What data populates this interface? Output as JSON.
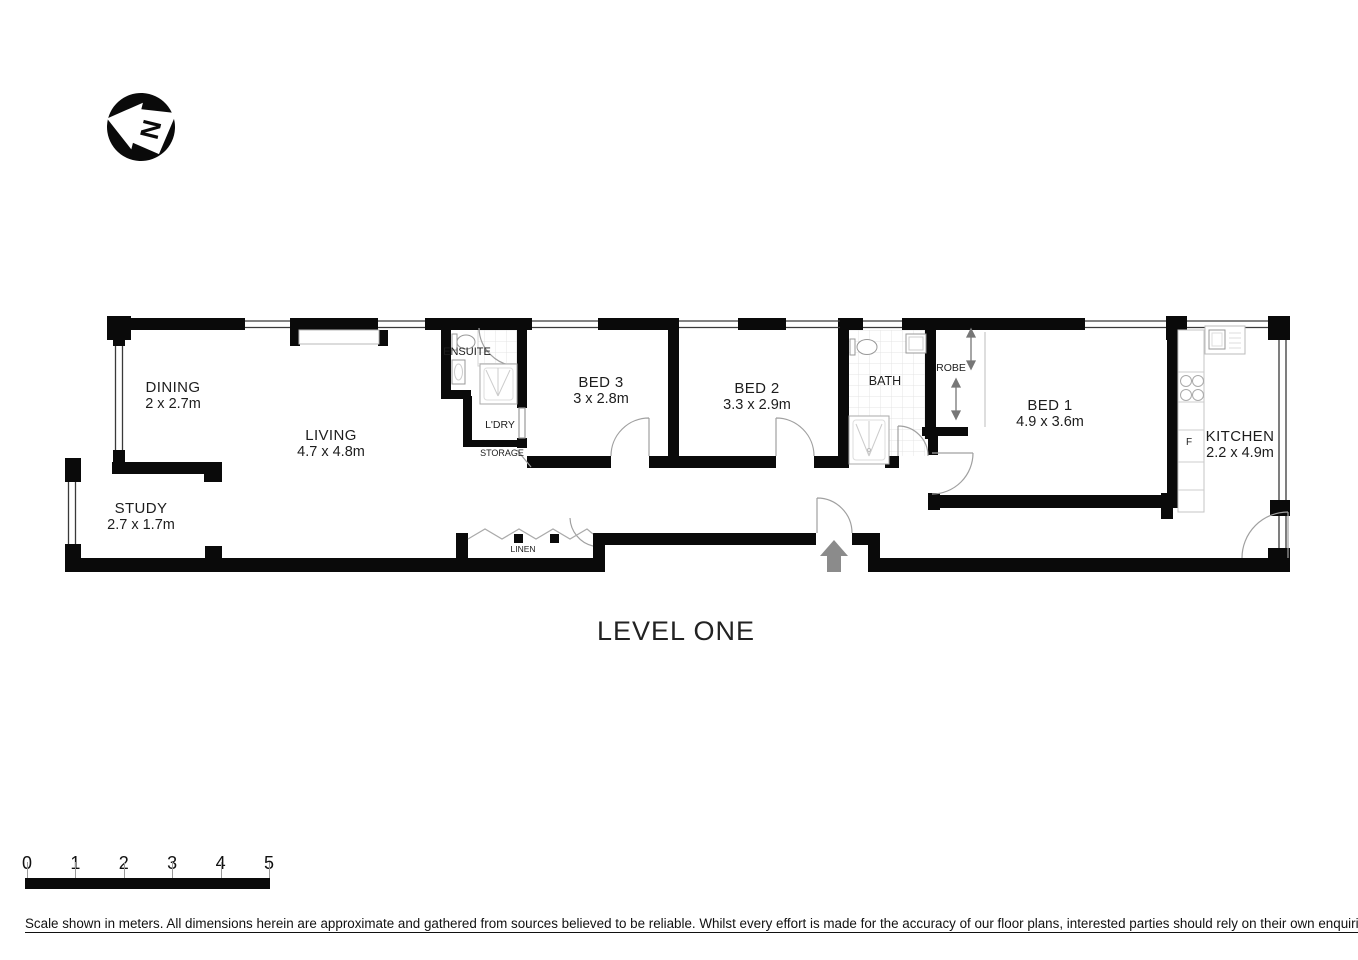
{
  "meta": {
    "level_title": "LEVEL ONE"
  },
  "compass": {
    "letter": "N"
  },
  "rooms": {
    "dining": {
      "name": "DINING",
      "dims": "2 x 2.7m"
    },
    "living": {
      "name": "LIVING",
      "dims": "4.7 x 4.8m"
    },
    "study": {
      "name": "STUDY",
      "dims": "2.7 x 1.7m"
    },
    "ensuite": {
      "name": "ENSUITE"
    },
    "ldry": {
      "name": "L'DRY"
    },
    "storage": {
      "name": "STORAGE"
    },
    "bed3": {
      "name": "BED 3",
      "dims": "3 x 2.8m"
    },
    "bed2": {
      "name": "BED 2",
      "dims": "3.3 x 2.9m"
    },
    "bath": {
      "name": "BATH"
    },
    "robe": {
      "name": "ROBE"
    },
    "bed1": {
      "name": "BED 1",
      "dims": "4.9 x 3.6m"
    },
    "kitchen": {
      "name": "KITCHEN",
      "dims": "2.2 x 4.9m"
    },
    "linen": {
      "name": "LINEN"
    }
  },
  "fixtures": {
    "fridge_label": "F"
  },
  "scale_bar": {
    "labels": [
      "0",
      "1",
      "2",
      "3",
      "4",
      "5"
    ],
    "unit": "meters"
  },
  "disclaimer": {
    "text": "Scale shown in meters. All dimensions herein are approximate and gathered from sources believed to be  reliable. Whilst every effort is made for the accuracy of our floor plans, interested parties should rely on their own enquiries."
  },
  "colors": {
    "wall": "#0a0a0a",
    "entry_arrow": "#8b8b8b",
    "fixture_stroke": "#999999",
    "tile": "#e4e4e4"
  }
}
